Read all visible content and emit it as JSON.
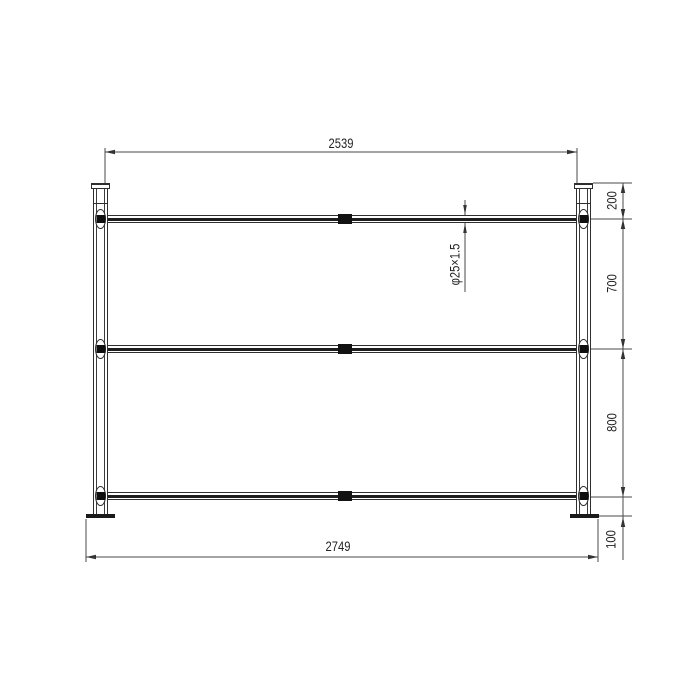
{
  "drawing": {
    "type": "technical-drawing",
    "background_color": "#ffffff",
    "line_color": "#2e2e2e",
    "dimension_line_color": "#4a4a4a",
    "text_color": "#242424",
    "labels": {
      "top_width": "2539",
      "bottom_width": "2749",
      "right_chain": [
        "200",
        "700",
        "800",
        "100"
      ],
      "tube_spec": "φ25×1.5"
    },
    "structure": {
      "posts": 2,
      "rails": 3,
      "base_plates": 2,
      "rail_fittings": 6,
      "rail_splices": 3
    }
  }
}
